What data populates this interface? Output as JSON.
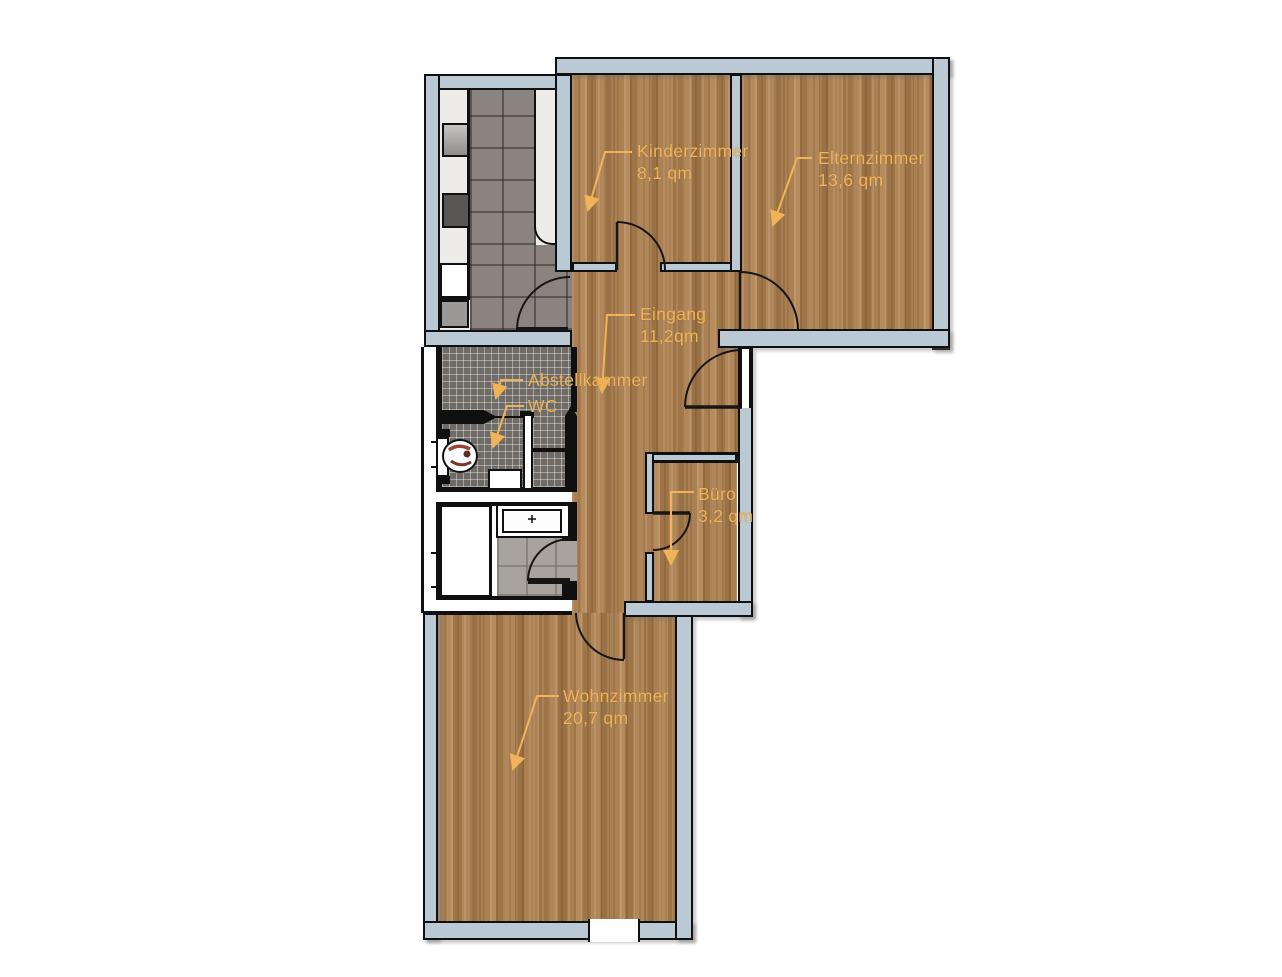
{
  "document": {
    "type": "apartment-floor-plan"
  },
  "labels": {
    "kinderzimmer": {
      "name": "Kinderzimmer",
      "area": "8,1 qm"
    },
    "elternzimmer": {
      "name": "Elternzimmer",
      "area": "13,6 qm"
    },
    "eingang": {
      "name": "Eingang",
      "area": "11,2qm"
    },
    "abstellkammer": {
      "name": "Abstellkammer",
      "area": ""
    },
    "wc": {
      "name": "WC",
      "area": ""
    },
    "buero": {
      "name": "Büro",
      "area": "3,2 qm"
    },
    "wohnzimmer": {
      "name": "Wohnzimmer",
      "area": "20,7 qm"
    }
  },
  "colors": {
    "wall_fill": "#bac9d4",
    "wall_outline": "#101010",
    "label_text": "#f0b357",
    "wood_floor": "#aa8053",
    "kitchen_tile": "#8b8380",
    "wc_tile": "#6f6b67",
    "bath_tile": "#a8a39e",
    "counter": "#edece8",
    "background": "#ffffff"
  }
}
